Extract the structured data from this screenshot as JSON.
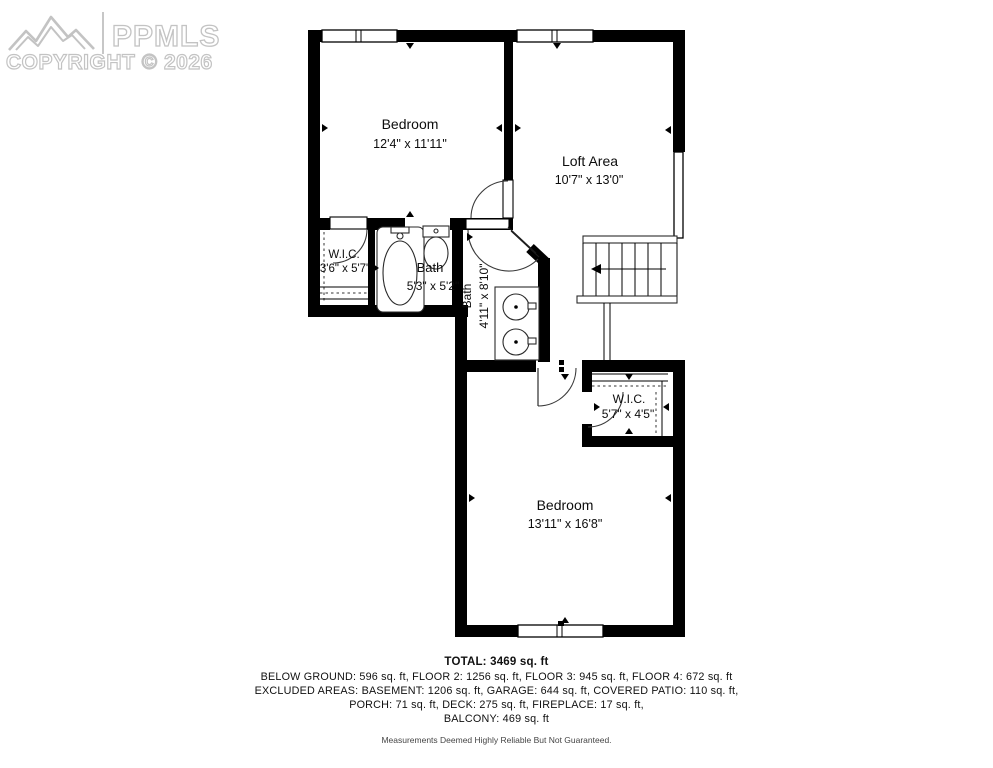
{
  "watermark": {
    "logo_text": "PPMLS",
    "copyright": "COPYRIGHT © 2026"
  },
  "rooms": {
    "bedroom1": {
      "name": "Bedroom",
      "dims": "12'4\" x 11'11\""
    },
    "loft": {
      "name": "Loft Area",
      "dims": "10'7\" x 13'0\""
    },
    "wic1": {
      "name": "W.I.C.",
      "dims": "3'6\" x 5'7\""
    },
    "bath1": {
      "name": "Bath",
      "dims": "5'3\" x 5'2\""
    },
    "bath2": {
      "name": "Bath",
      "dims": "4'11\" x 8'10\""
    },
    "wic2": {
      "name": "W.I.C.",
      "dims": "5'7\" x 4'5\""
    },
    "bedroom2": {
      "name": "Bedroom",
      "dims": "13'11\" x 16'8\""
    }
  },
  "footer": {
    "total": "TOTAL: 3469 sq. ft",
    "line1": "BELOW GROUND: 596 sq. ft, FLOOR 2: 1256 sq. ft, FLOOR 3: 945 sq. ft, FLOOR 4: 672 sq. ft",
    "line2": "EXCLUDED AREAS: BASEMENT: 1206 sq. ft, GARAGE: 644 sq. ft, COVERED PATIO: 110 sq. ft,",
    "line3": "PORCH: 71 sq. ft, DECK: 275 sq. ft, FIREPLACE: 17 sq. ft,",
    "line4": "BALCONY: 469 sq. ft",
    "disclaimer": "Measurements Deemed Highly Reliable But Not Guaranteed."
  },
  "colors": {
    "wall": "#000000",
    "watermark_gray": "#c3c3c3",
    "background": "#ffffff"
  }
}
